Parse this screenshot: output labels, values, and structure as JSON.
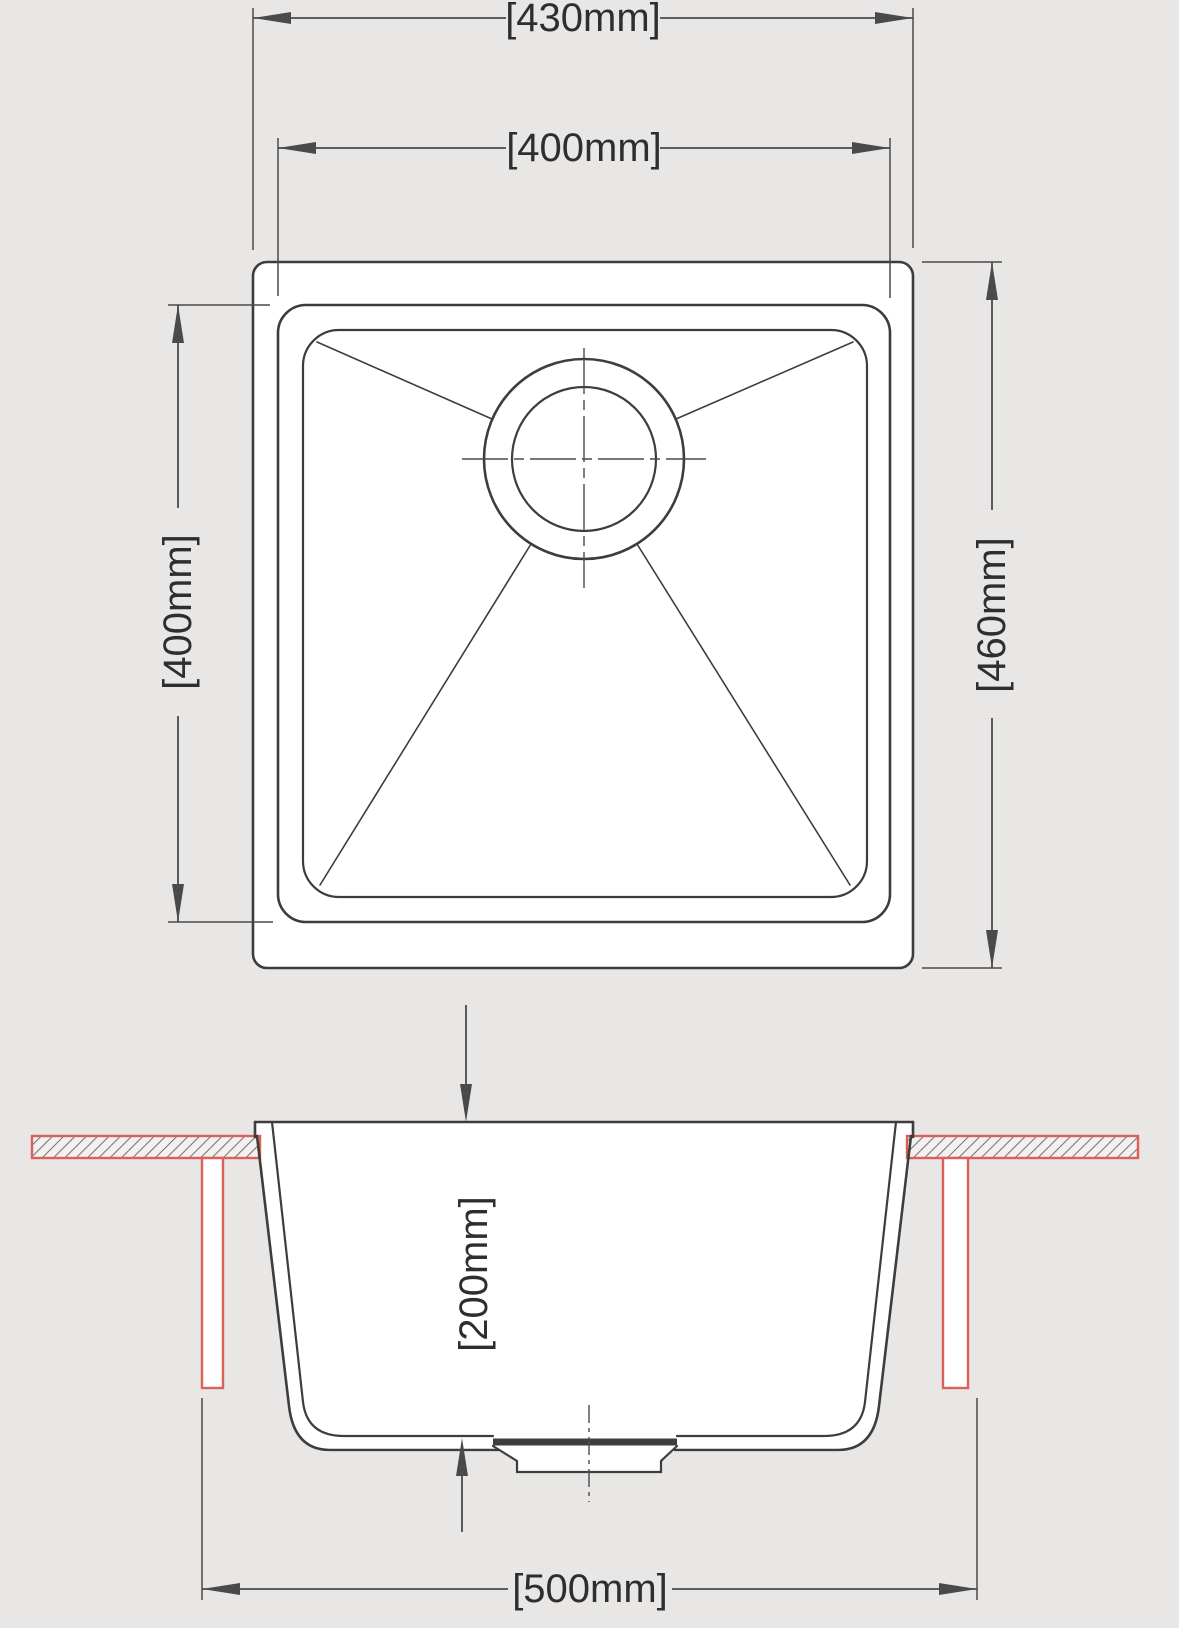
{
  "colors": {
    "background": "#e8e7e5",
    "white": "#ffffff",
    "line": "#3d3d3d",
    "dim": "#4a4a4a",
    "text": "#2e2e2e",
    "red": "#dd5f58",
    "hatch_fill": "#f2f1ef",
    "hatch_line": "#757575"
  },
  "plan_view": {
    "dim_overall_width": "[430mm]",
    "dim_bowl_width": "[400mm]",
    "dim_bowl_length": "[400mm]",
    "dim_overall_length": "[460mm]"
  },
  "section_view": {
    "dim_bowl_depth": "[200mm]",
    "dim_base_width": "[500mm]"
  }
}
